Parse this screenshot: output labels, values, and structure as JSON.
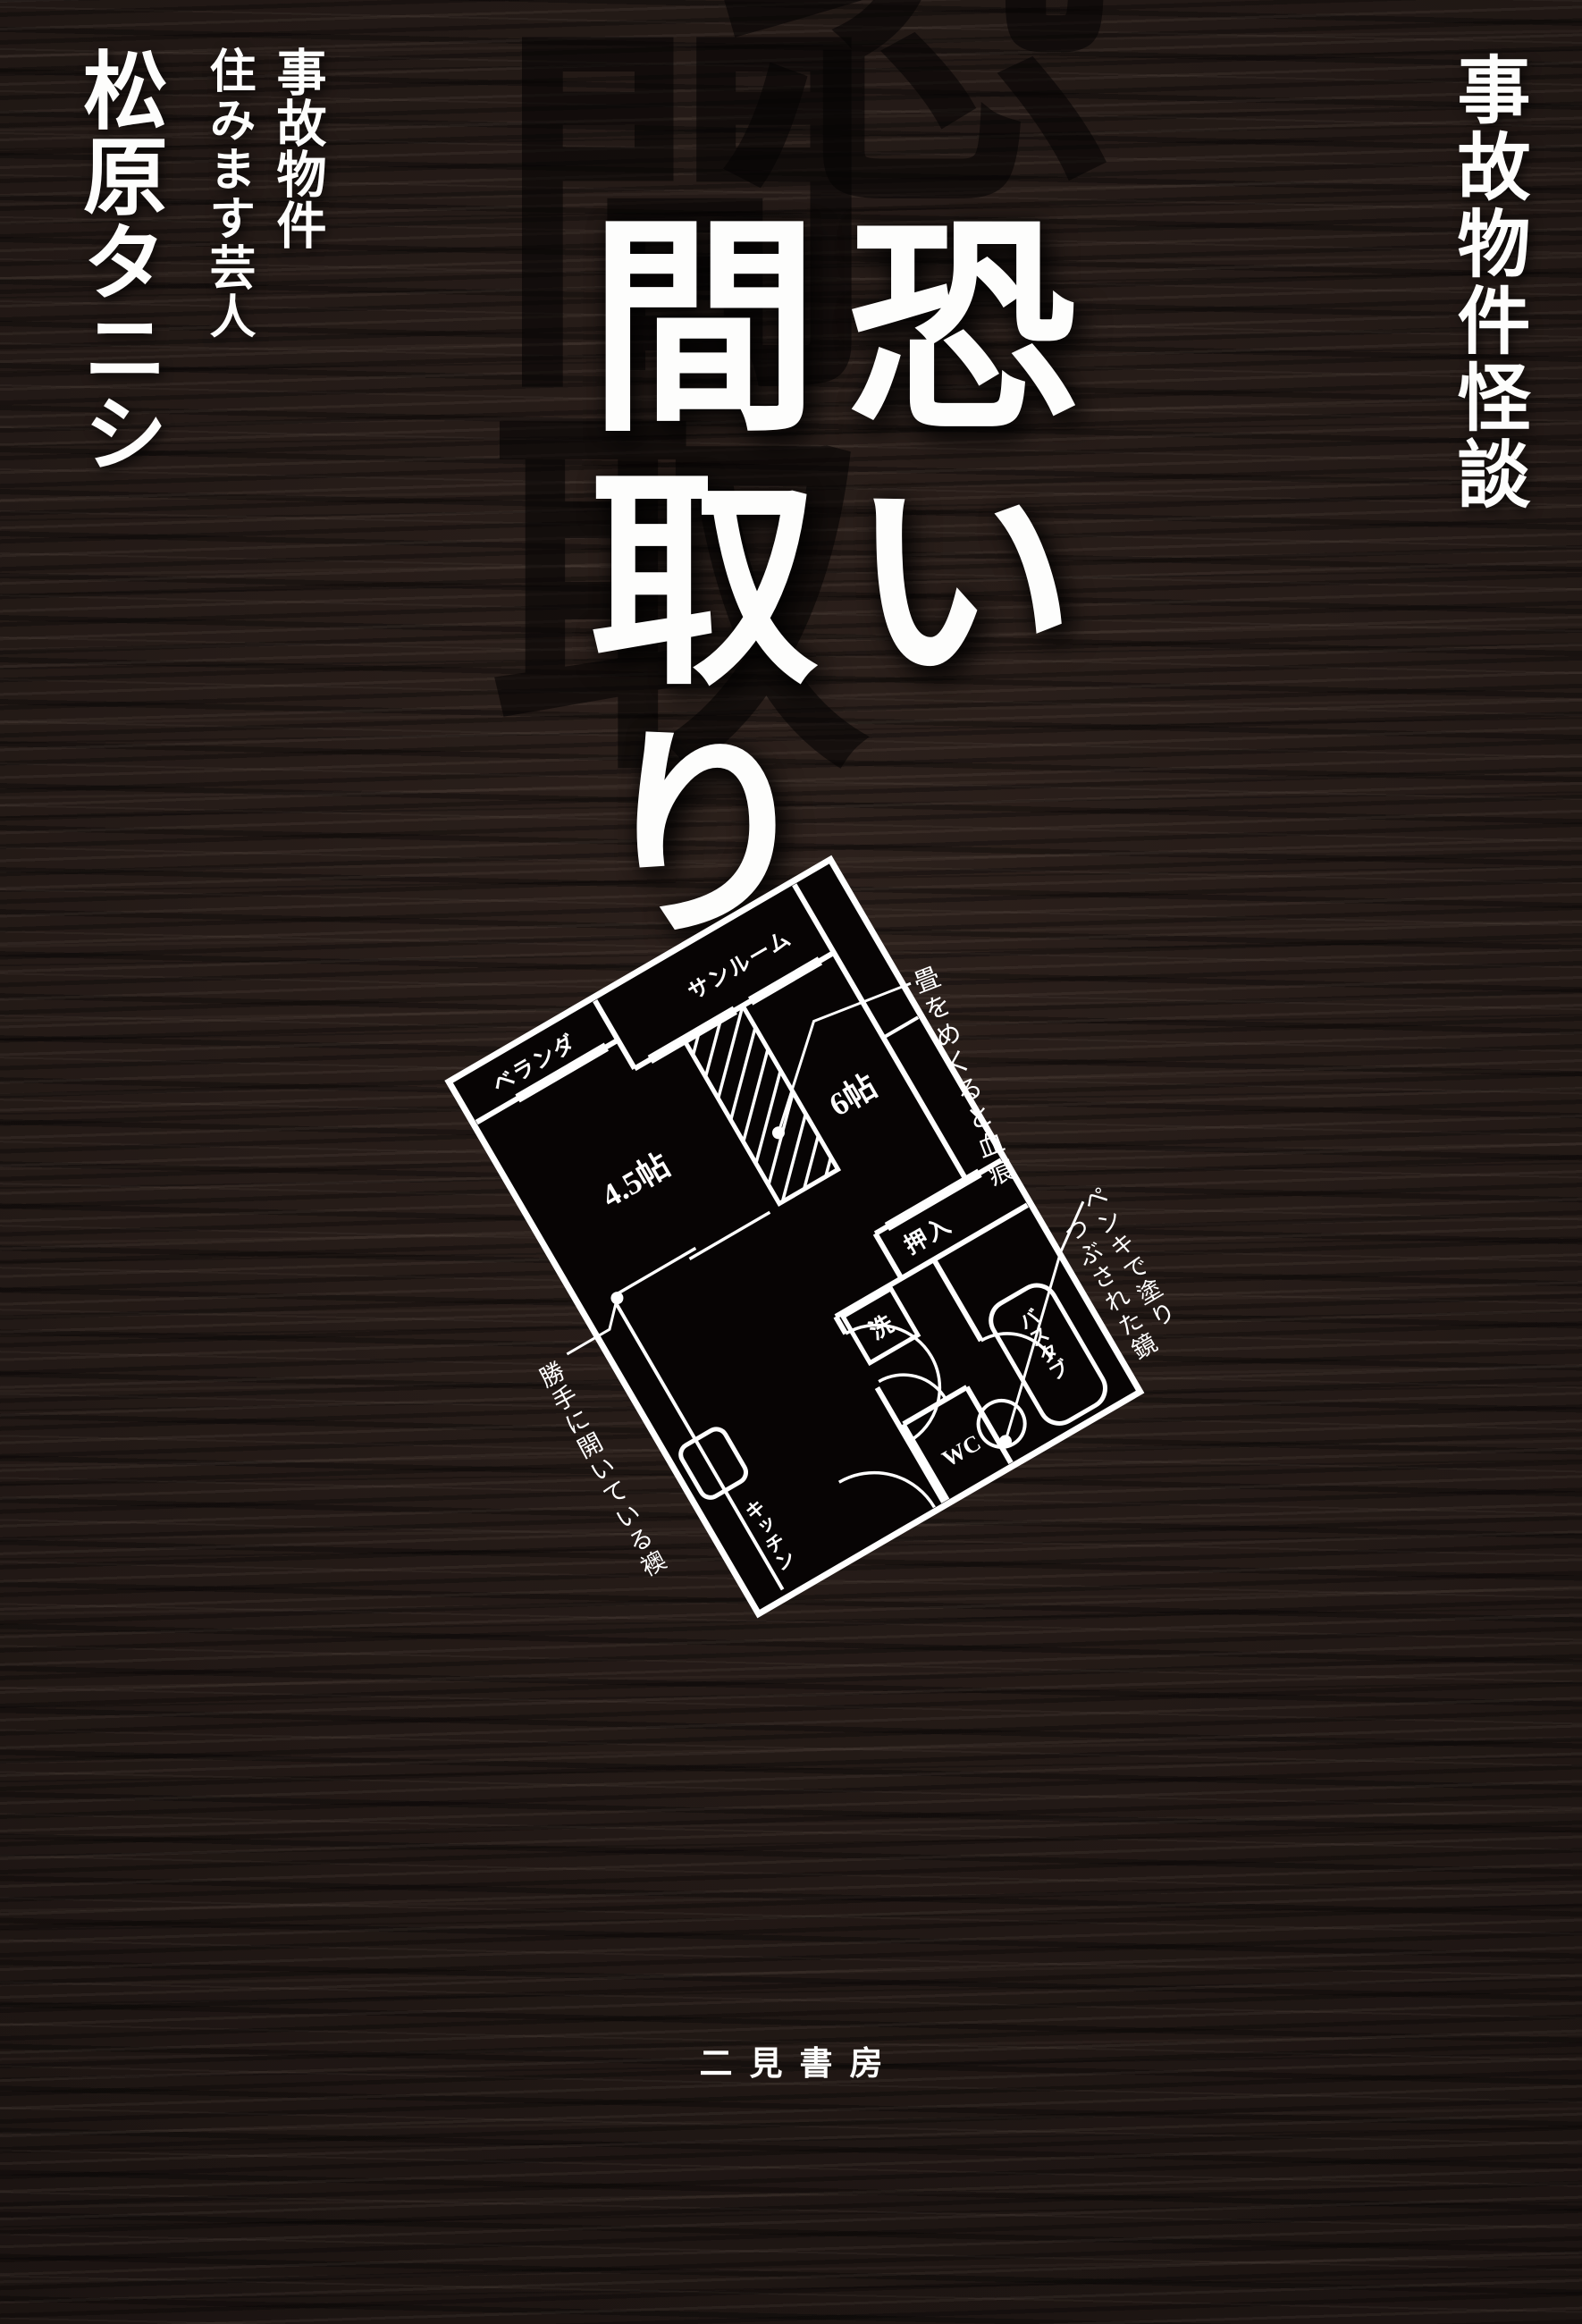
{
  "colors": {
    "background": "#241b18",
    "ink": "#ffffff",
    "ghost": "#060303",
    "plan_fill": "#070404"
  },
  "series_subtitle": "事故物件怪談",
  "author_block": {
    "qualifier_line1": "事故物件",
    "qualifier_line2": "住みます芸人",
    "author_name": "松原タニシ"
  },
  "title": {
    "column_right": "恐い",
    "column_left": "間取り",
    "ghost_characters": [
      "恐",
      "間",
      "取"
    ]
  },
  "floorplan": {
    "rooms": {
      "balcony": "ベランダ",
      "sunroom": "サンルーム",
      "tatami_4_5": "4.5帖",
      "tatami_6": "6帖",
      "closet": "押入",
      "laundry": "洗",
      "toilet": "WC",
      "bathtub": "バスタブ",
      "kitchen": "キッチン"
    },
    "annotations": {
      "tatami_blood": "畳をめくると血痕",
      "fusuma": "勝手に開いている襖",
      "mirror_line1": "ペンキで塗り",
      "mirror_line2": "つぶされた鏡"
    }
  },
  "publisher": {
    "name": "二見書房"
  }
}
